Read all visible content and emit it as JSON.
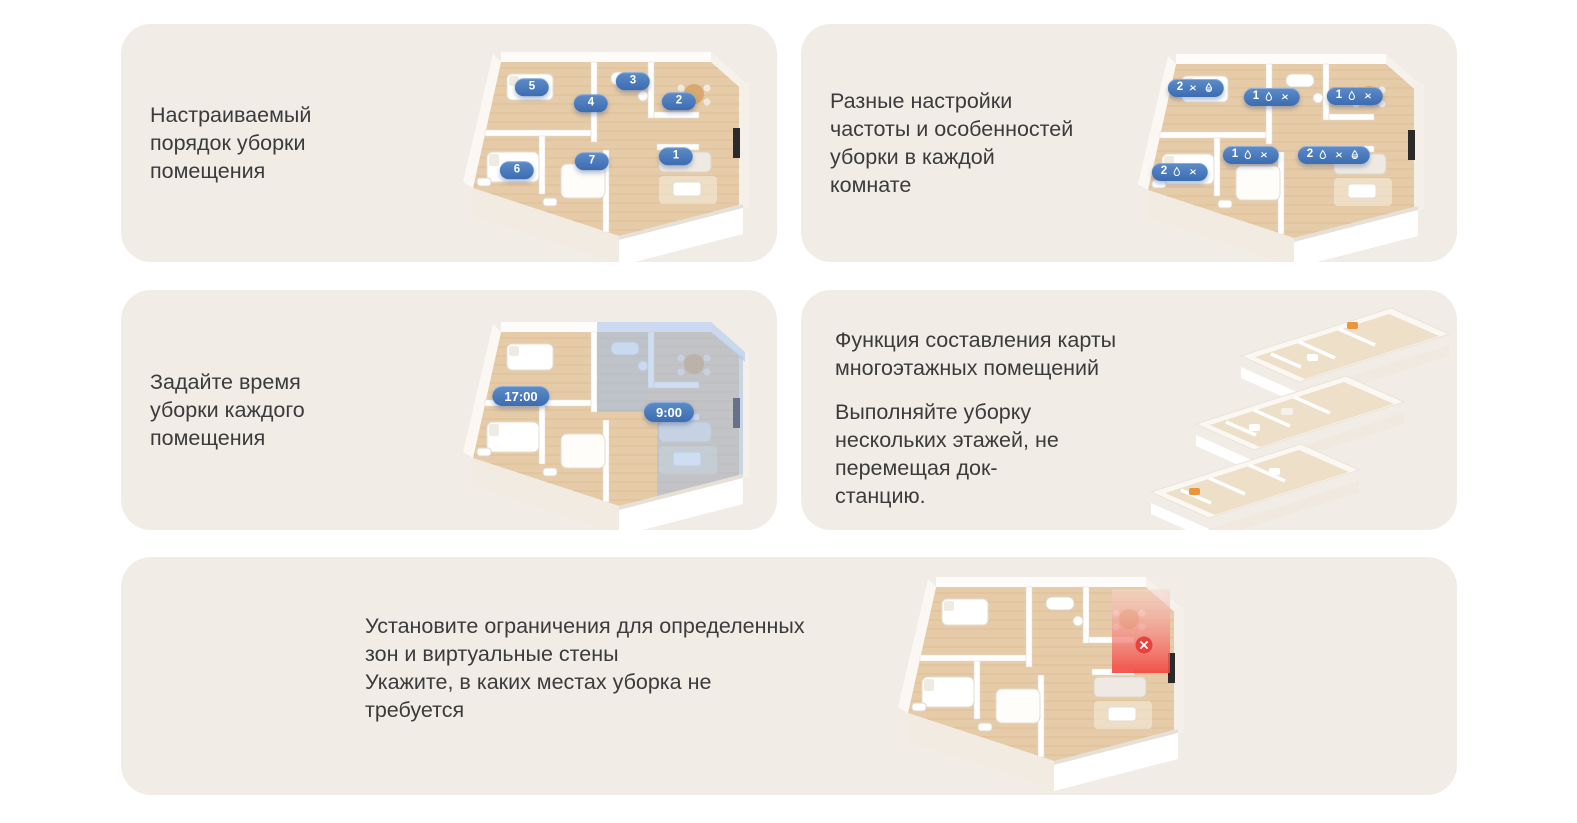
{
  "page": {
    "language": "ru",
    "background": "#ffffff"
  },
  "theme": {
    "card_background": "#f1ece6",
    "text_color": "#3b3b3b",
    "badge_gradient_start": "#5d8cca",
    "badge_gradient_end": "#3c6cb1",
    "badge_text_color": "#ffffff",
    "schedule_highlight_blue": "#9dbbe4",
    "no_go_zone_red": "#f2453f",
    "wood_floor": "#e6cba8"
  },
  "cards": [
    {
      "id": "cleaning-order",
      "title_lines": [
        "Настраиваемый",
        "порядок уборки",
        "помещения"
      ],
      "badges": [
        {
          "label": "5",
          "x": 89,
          "y": 51
        },
        {
          "label": "3",
          "x": 190,
          "y": 45
        },
        {
          "label": "4",
          "x": 148,
          "y": 67
        },
        {
          "label": "2",
          "x": 236,
          "y": 65
        },
        {
          "label": "7",
          "x": 149,
          "y": 125
        },
        {
          "label": "1",
          "x": 233,
          "y": 120
        },
        {
          "label": "6",
          "x": 74,
          "y": 134
        }
      ]
    },
    {
      "id": "per-room-settings",
      "title_lines": [
        "Разные настройки",
        "частоты и особенностей",
        "уборки в каждой",
        "комнате"
      ],
      "badges": [
        {
          "label": "2",
          "icons": [
            "fan",
            "water-level"
          ],
          "x": 78,
          "y": 50
        },
        {
          "label": "1",
          "icons": [
            "water-drop",
            "fan"
          ],
          "x": 154,
          "y": 59
        },
        {
          "label": "1",
          "icons": [
            "water-drop",
            "fan"
          ],
          "x": 237,
          "y": 58
        },
        {
          "label": "1",
          "icons": [
            "water-drop",
            "fan"
          ],
          "x": 133,
          "y": 117
        },
        {
          "label": "2",
          "icons": [
            "water-drop",
            "fan",
            "water-level"
          ],
          "x": 216,
          "y": 117
        },
        {
          "label": "2",
          "icons": [
            "water-drop",
            "fan"
          ],
          "x": 62,
          "y": 134
        }
      ]
    },
    {
      "id": "room-schedule",
      "title_lines": [
        "Задайте время",
        "уборки каждого",
        "помещения"
      ],
      "badges": [
        {
          "label": "17:00",
          "kind": "time",
          "x": 78,
          "y": 90
        },
        {
          "label": "9:00",
          "kind": "time",
          "x": 226,
          "y": 106
        }
      ]
    },
    {
      "id": "multi-floor-map",
      "heading_lines": [
        "Функция составления карты",
        "многоэтажных помещений"
      ],
      "body_lines": [
        "Выполняйте уборку",
        "нескольких этажей, не",
        "перемещая док-",
        "станцию."
      ]
    },
    {
      "id": "no-go-zones",
      "lines": [
        "Установите ограничения для определенных",
        "зон и виртуальные стены",
        "Укажите, в каких местах уборка не",
        "требуется"
      ]
    }
  ]
}
